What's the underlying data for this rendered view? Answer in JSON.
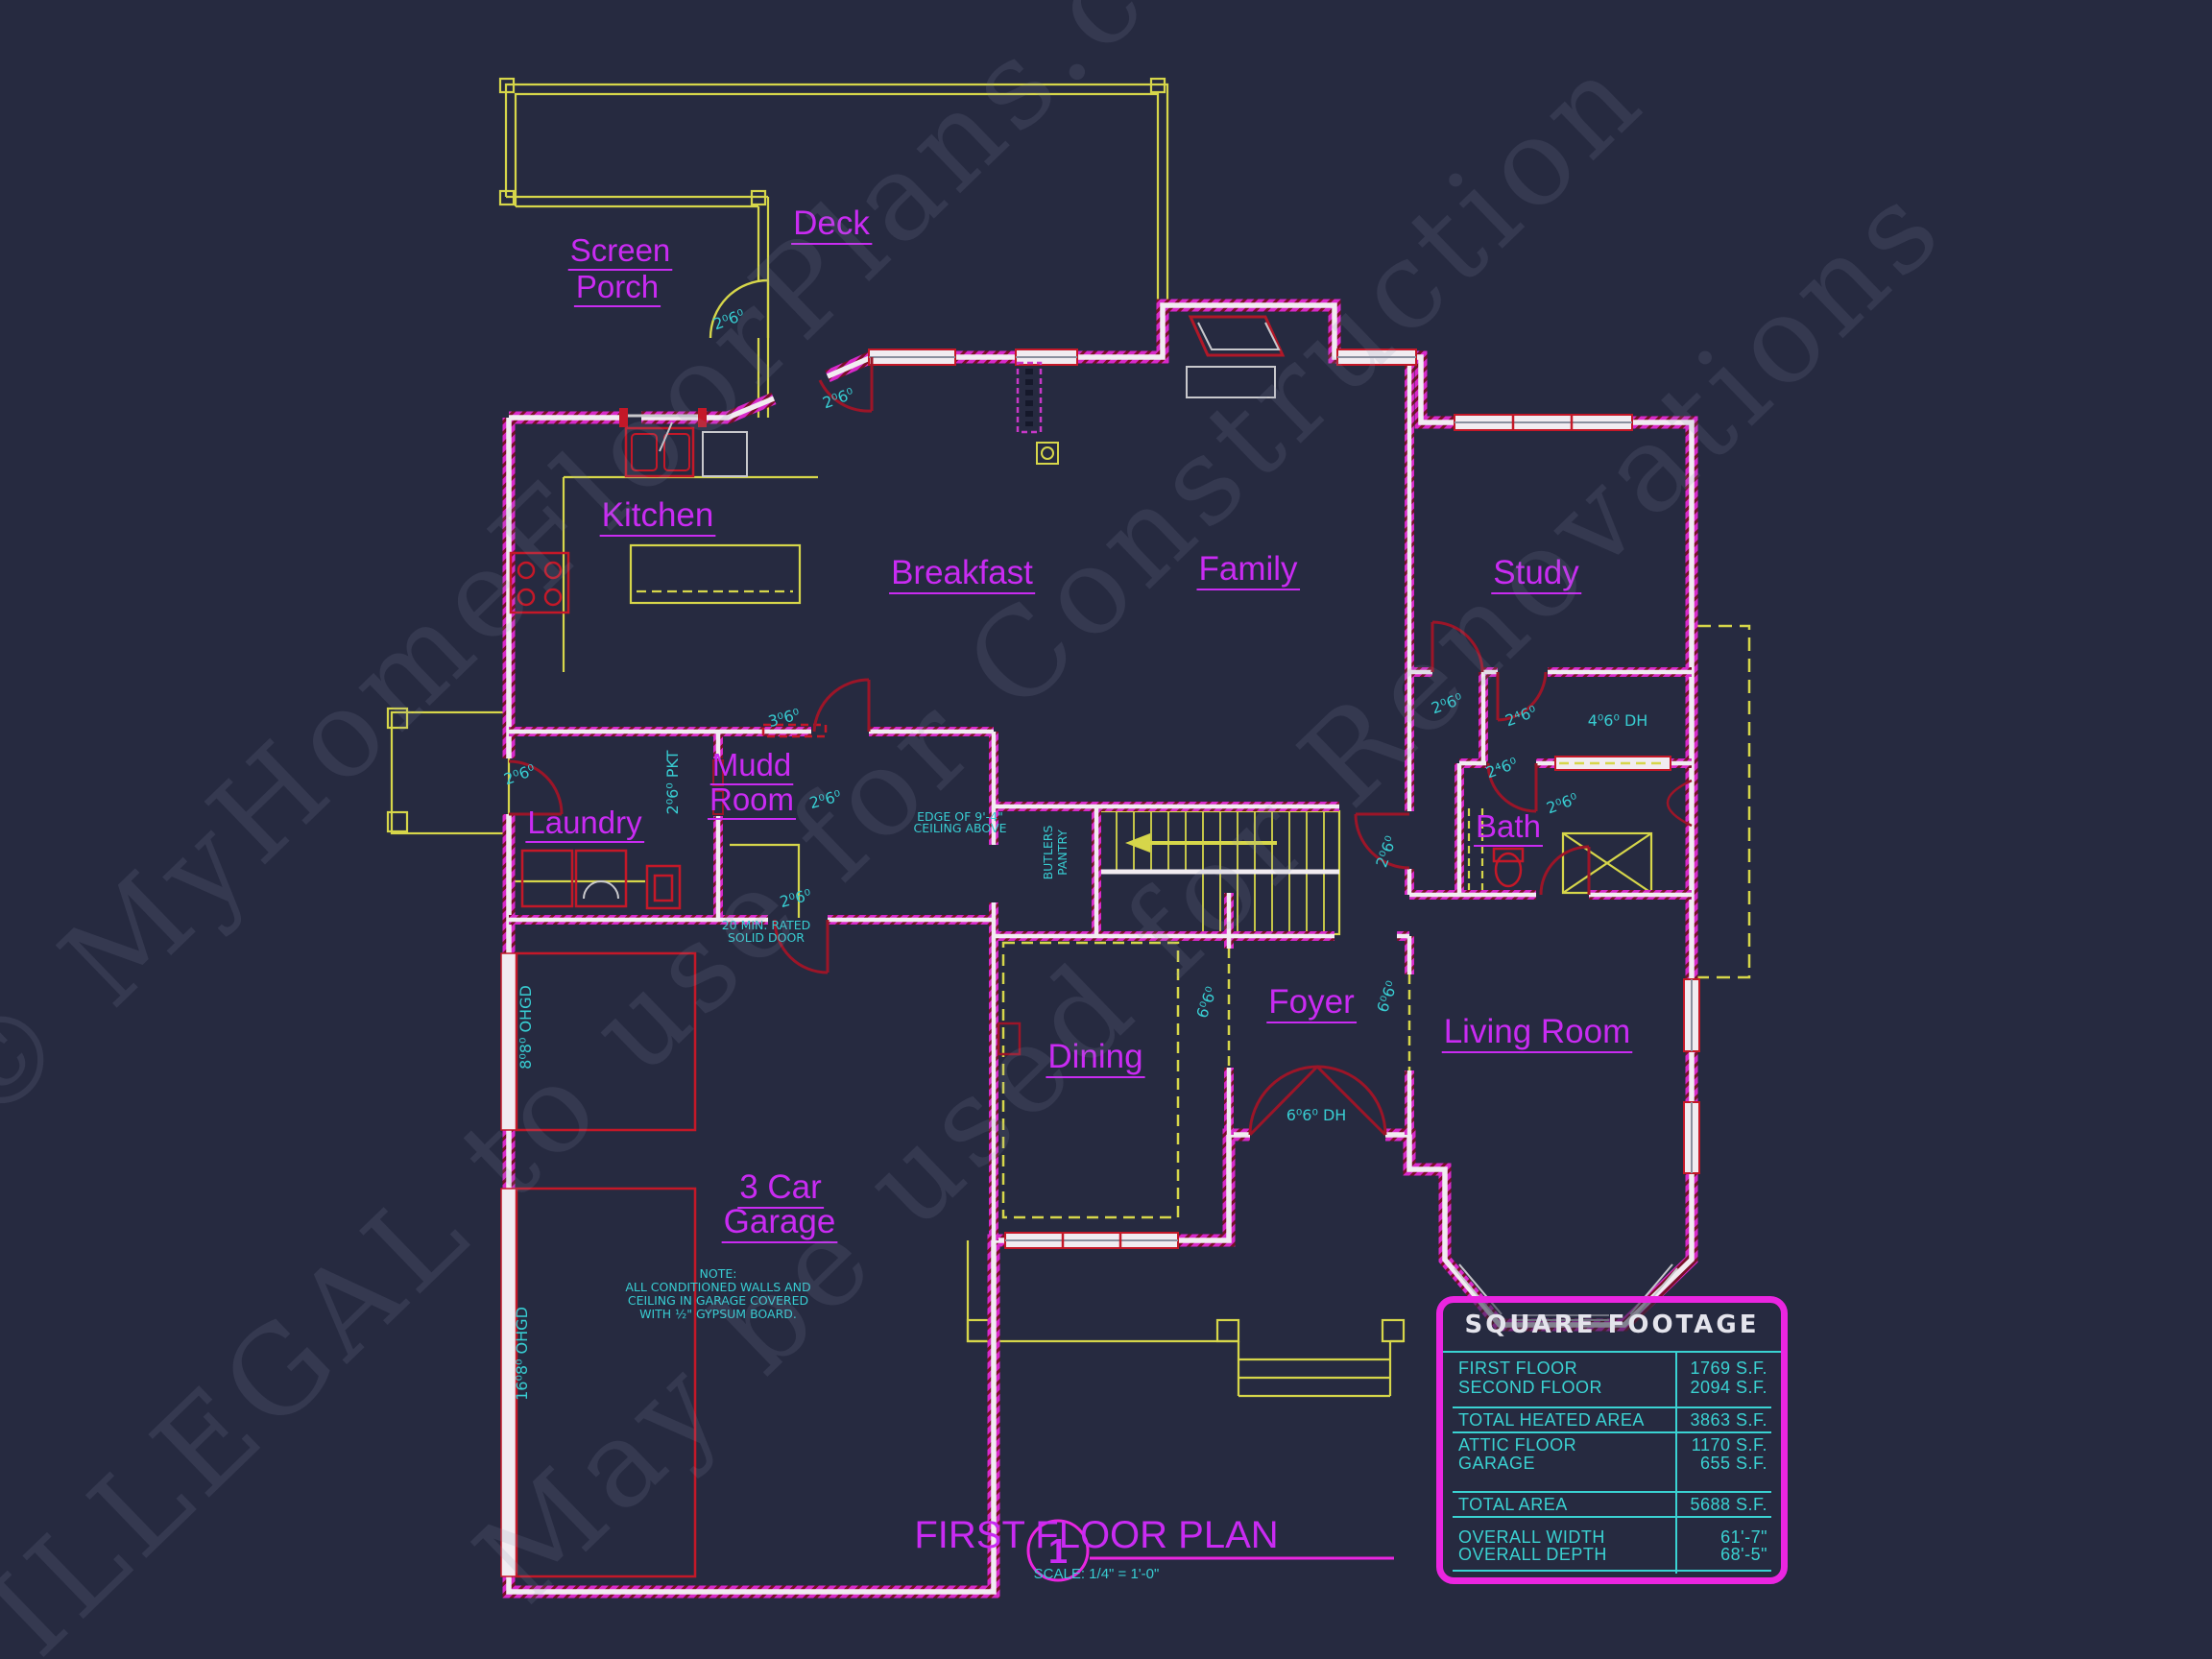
{
  "watermark": {
    "line1": "© MyHomeFloorPlans.com",
    "line2": "ILLEGAL to use for Construction",
    "line3": "May be used for Renovations"
  },
  "rooms": {
    "deck": "Deck",
    "screen": "Screen",
    "porch": "Porch",
    "kitchen": "Kitchen",
    "breakfast": "Breakfast",
    "family": "Family",
    "study": "Study",
    "mudd": "Mudd",
    "room": "Room",
    "laundry": "Laundry",
    "bath": "Bath",
    "foyer": "Foyer",
    "living": "Living Room",
    "dining": "Dining",
    "garage1": "3 Car",
    "garage2": "Garage"
  },
  "ann": {
    "door_2060": "2⁰6⁰",
    "door_2460": "2⁴6⁰",
    "door_pkt": "2⁰6⁰ PKT",
    "win_3060": "3⁰6⁰",
    "win_4060dh": "4⁰6⁰ DH",
    "open_6060": "6⁰6⁰",
    "door_6060dh": "6⁰6⁰ DH",
    "ohgd_8": "8⁰8⁰ OHGD",
    "ohgd_16": "16⁰8⁰ OHGD",
    "rated1": "20 MIN. RATED",
    "rated2": "SOLID DOOR",
    "edge1": "EDGE OF 9'-4\"",
    "edge2": "CEILING ABOVE",
    "butlers1": "BUTLERS",
    "butlers2": "PANTRY"
  },
  "note": {
    "l0": "NOTE:",
    "l1": "ALL CONDITIONED WALLS AND",
    "l2": "CEILING IN GARAGE COVERED",
    "l3": "WITH ½\" GYPSUM BOARD."
  },
  "titleblock": {
    "number": "1",
    "title": "FIRST FLOOR PLAN",
    "scale": "SCALE: 1/4\" = 1'-0\""
  },
  "table": {
    "title": "SQUARE FOOTAGE",
    "rows": [
      {
        "label": "FIRST FLOOR",
        "value": "1769 S.F."
      },
      {
        "label": "SECOND FLOOR",
        "value": "2094 S.F."
      },
      {
        "label": "TOTAL HEATED AREA",
        "value": "3863 S.F."
      },
      {
        "label": "ATTIC FLOOR",
        "value": "1170 S.F."
      },
      {
        "label": "GARAGE",
        "value": "655 S.F."
      },
      {
        "label": "TOTAL AREA",
        "value": "5688 S.F."
      },
      {
        "label": "OVERALL WIDTH",
        "value": "61'-7\""
      },
      {
        "label": "OVERALL DEPTH",
        "value": "68'-5\""
      }
    ]
  },
  "colors": {
    "background": "#262a40",
    "wall_magenta": "#d829c9",
    "wall_core": "#f1ecf1",
    "accent_red": "#c41828",
    "door_red": "#9c1528",
    "cad_yellow": "#d6d64a",
    "annotation_cyan": "#38cdd2",
    "label_purple": "#c92bf2",
    "table_magenta": "#ea25e0"
  }
}
